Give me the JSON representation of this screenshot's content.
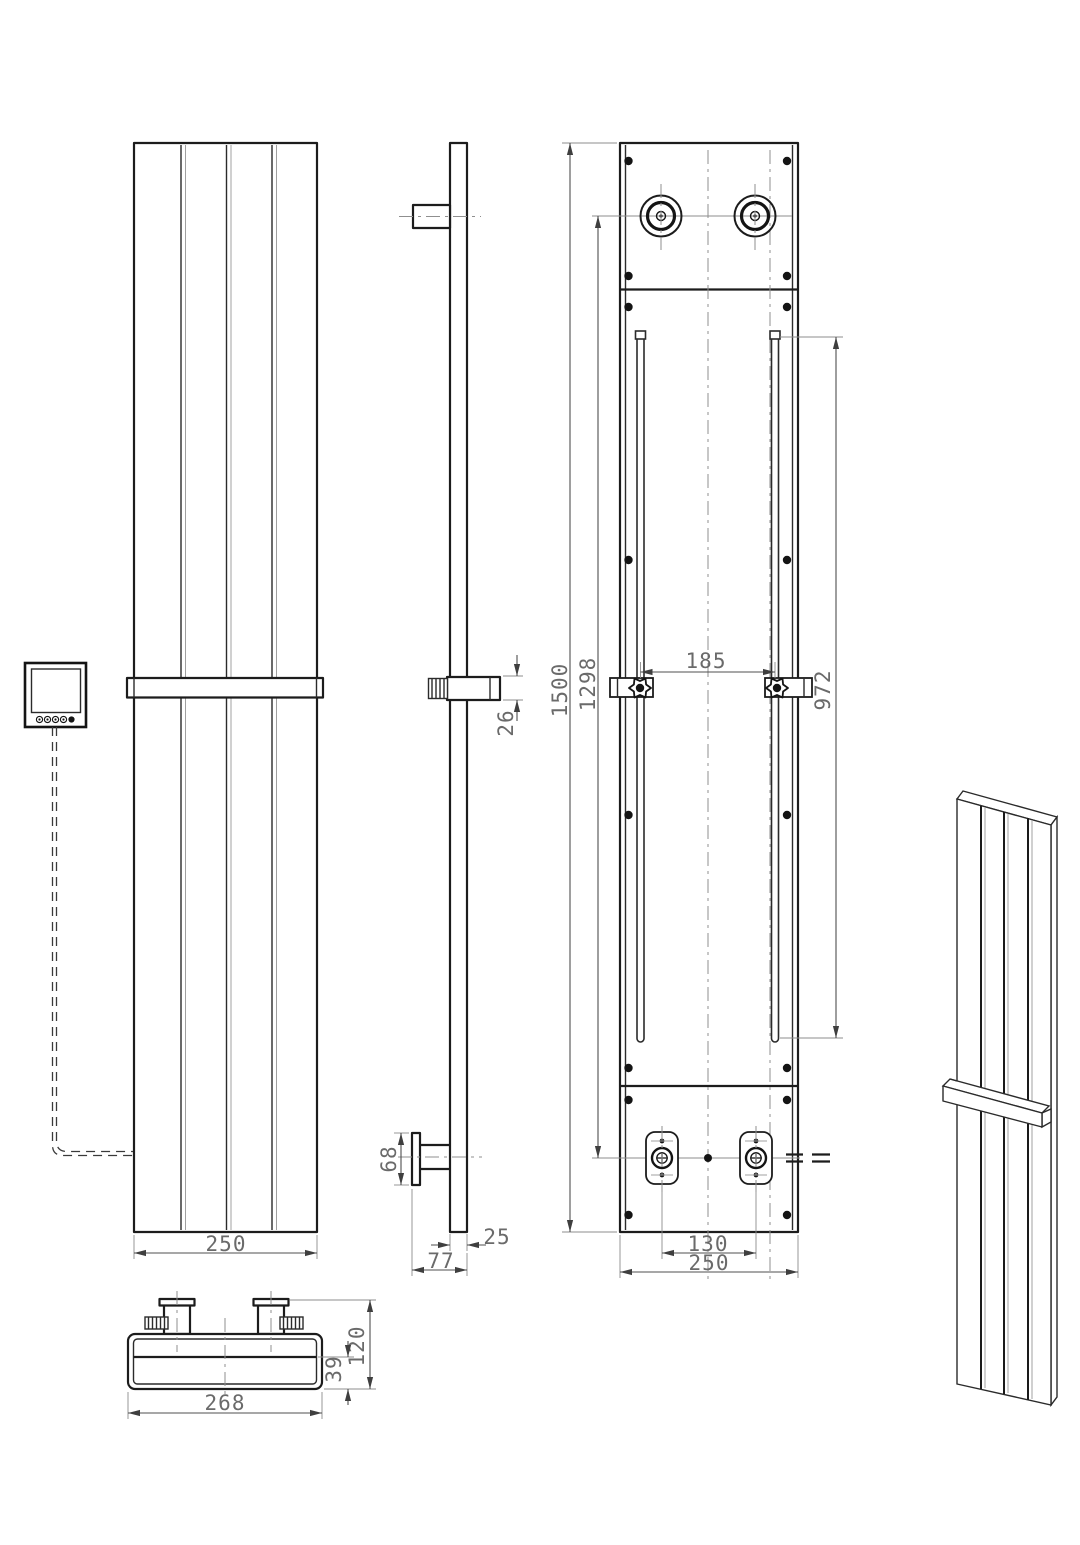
{
  "drawing": {
    "subject": "vertical-panel-radiator-technical-drawing",
    "background": "#ffffff",
    "outline_color": "#1c1c1c",
    "dimension_color": "#6a6a6a",
    "centerline_color": "#8f8f8f",
    "views": {
      "front": {
        "label": "front-view",
        "dims": {
          "width": "250"
        }
      },
      "side": {
        "label": "side-view",
        "dims": {
          "bracket_depth": "26",
          "flange_height": "68",
          "panel_thickness": "25",
          "total_depth": "77"
        }
      },
      "rear": {
        "label": "rear-view",
        "dims": {
          "overall_height": "1500",
          "connection_height": "1298",
          "rail_length": "972",
          "rail_spacing": "185",
          "connection_spacing": "130",
          "width": "250"
        }
      },
      "top": {
        "label": "top-view",
        "dims": {
          "overall_width": "268",
          "overall_depth": "120",
          "body_depth": "39"
        }
      },
      "perspective": {
        "label": "perspective-view"
      }
    }
  }
}
